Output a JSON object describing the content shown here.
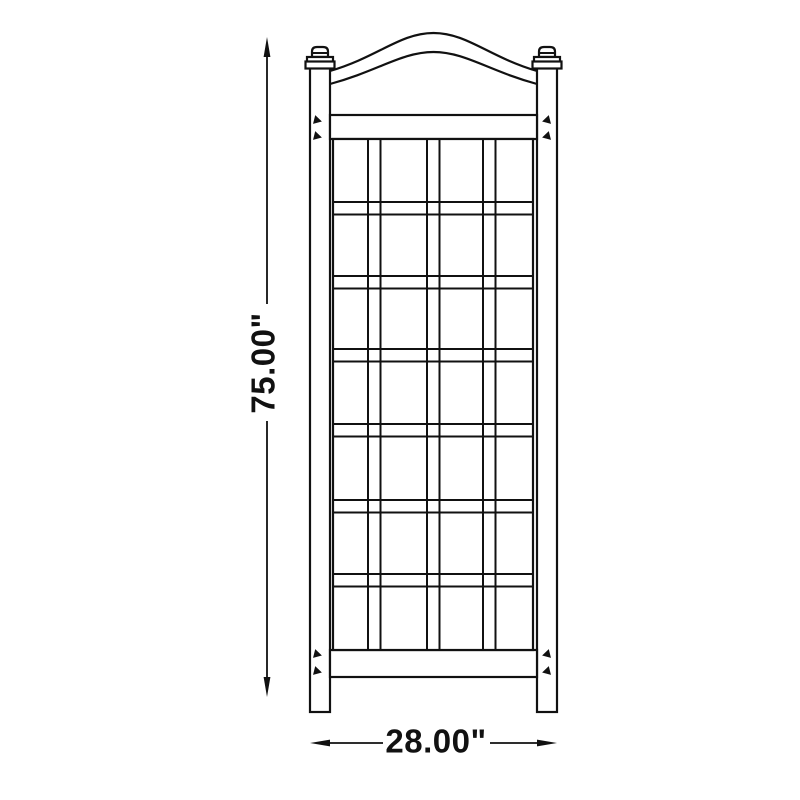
{
  "diagram": {
    "background_color": "#ffffff",
    "line_color": "#111111",
    "dimensions": {
      "height": {
        "label": "75.00\"",
        "value": 75,
        "unit": "inches"
      },
      "width": {
        "label": "28.00\"",
        "value": 28,
        "unit": "inches"
      }
    },
    "structure": {
      "lattice_rows": 7,
      "lattice_columns": 4,
      "posts": 2,
      "finials": 2,
      "screw_marks": 8
    },
    "icons": {
      "dimension_arrow": "filled-triangle",
      "screw_mark": "small-wedge"
    }
  }
}
